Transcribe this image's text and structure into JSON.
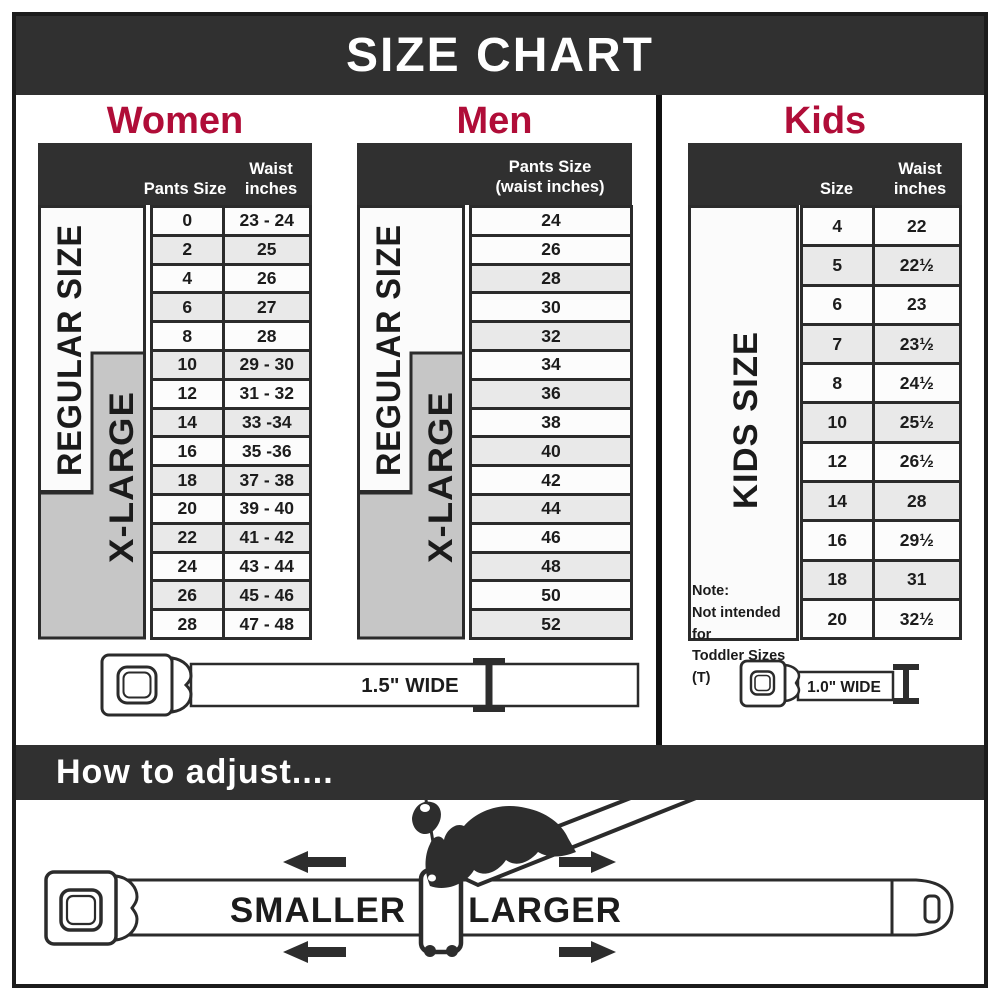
{
  "title": "SIZE CHART",
  "women": {
    "heading": "Women",
    "regular_label": "REGULAR SIZE",
    "xlarge_label": "X-LARGE",
    "col1_header": "Pants Size",
    "col2_header_line1": "Waist",
    "col2_header_line2": "inches",
    "rows": [
      [
        "0",
        "23 - 24"
      ],
      [
        "2",
        "25"
      ],
      [
        "4",
        "26"
      ],
      [
        "6",
        "27"
      ],
      [
        "8",
        "28"
      ],
      [
        "10",
        "29 - 30"
      ],
      [
        "12",
        "31 - 32"
      ],
      [
        "14",
        "33 -34"
      ],
      [
        "16",
        "35 -36"
      ],
      [
        "18",
        "37 - 38"
      ],
      [
        "20",
        "39 - 40"
      ],
      [
        "22",
        "41 - 42"
      ],
      [
        "24",
        "43 - 44"
      ],
      [
        "26",
        "45 - 46"
      ],
      [
        "28",
        "47 - 48"
      ]
    ]
  },
  "men": {
    "heading": "Men",
    "regular_label": "REGULAR SIZE",
    "xlarge_label": "X-LARGE",
    "header_line1": "Pants Size",
    "header_line2": "(waist inches)",
    "rows": [
      [
        "24"
      ],
      [
        "26"
      ],
      [
        "28"
      ],
      [
        "30"
      ],
      [
        "32"
      ],
      [
        "34"
      ],
      [
        "36"
      ],
      [
        "38"
      ],
      [
        "40"
      ],
      [
        "42"
      ],
      [
        "44"
      ],
      [
        "46"
      ],
      [
        "48"
      ],
      [
        "50"
      ],
      [
        "52"
      ]
    ]
  },
  "kids": {
    "heading": "Kids",
    "size_label": "KIDS SIZE",
    "col1_header": "Size",
    "col2_header_line1": "Waist",
    "col2_header_line2": "inches",
    "rows": [
      [
        "4",
        "22"
      ],
      [
        "5",
        "22½"
      ],
      [
        "6",
        "23"
      ],
      [
        "7",
        "23½"
      ],
      [
        "8",
        "24½"
      ],
      [
        "10",
        "25½"
      ],
      [
        "12",
        "26½"
      ],
      [
        "14",
        "28"
      ],
      [
        "16",
        "29½"
      ],
      [
        "18",
        "31"
      ],
      [
        "20",
        "32½"
      ]
    ],
    "note_line1": "Note:",
    "note_line2": "Not intended for",
    "note_line3": "Toddler Sizes (T)"
  },
  "belts": {
    "adult_width_label": "1.5\" WIDE",
    "kids_width_label": "1.0\" WIDE"
  },
  "adjust": {
    "heading": "How to adjust....",
    "smaller_label": "SMALLER",
    "larger_label": "LARGER"
  },
  "colors": {
    "banner_dark": "#303030",
    "accent_red": "#b00d38",
    "row_alt_gray": "#e9e9e9",
    "xlarge_gray": "#c6c6c6"
  }
}
